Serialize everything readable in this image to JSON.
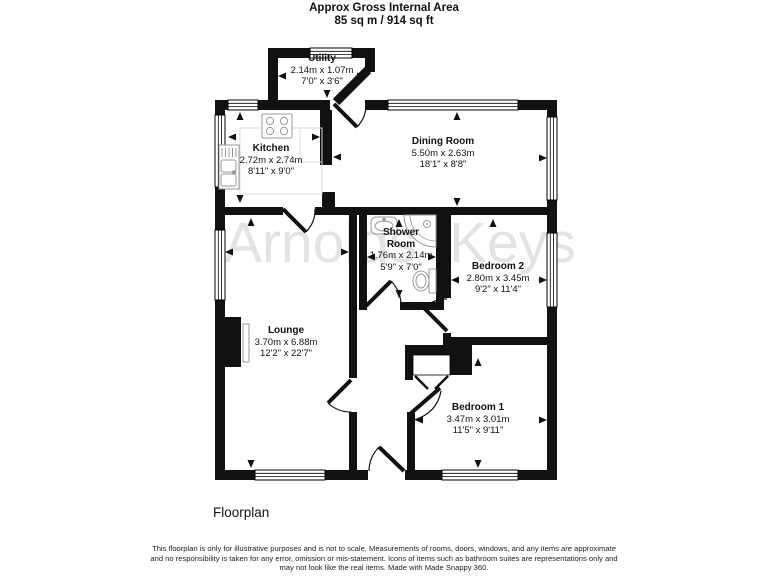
{
  "header": {
    "line1": "Approx Gross Internal Area",
    "line2": "85 sq m / 914 sq ft"
  },
  "watermark": "Arnolds Keys",
  "rooms": {
    "utility": {
      "name": "Utility",
      "metric": "2.14m x 1.07m",
      "imperial": "7'0\" x 3'6\""
    },
    "kitchen": {
      "name": "Kitchen",
      "metric": "2.72m x 2.74m",
      "imperial": "8'11\" x 9'0\""
    },
    "dining": {
      "name": "Dining Room",
      "metric": "5.50m x 2.63m",
      "imperial": "18'1\" x 8'8\""
    },
    "shower": {
      "name": "Shower Room",
      "metric": "1.76m x 2.14m",
      "imperial": "5'9\" x 7'0\""
    },
    "bedroom2": {
      "name": "Bedroom 2",
      "metric": "2.80m x 3.45m",
      "imperial": "9'2\" x 11'4\""
    },
    "lounge": {
      "name": "Lounge",
      "metric": "3.70m x 6.88m",
      "imperial": "12'2\" x 22'7\""
    },
    "bedroom1": {
      "name": "Bedroom 1",
      "metric": "3.47m x 3.01m",
      "imperial": "11'5\" x 9'11\""
    }
  },
  "footer": {
    "caption": "Floorplan",
    "disclaimer1": "This floorplan is only for illustrative purposes and is not to scale. Measurements of rooms, doors, windows, and any items are approximate",
    "disclaimer2": "and no responsibility is taken for any error, omission or mis-statement. Icons of items such as bathroom suites are representations only and",
    "disclaimer3": "may not look like the real items. Made with Made Snappy 360."
  },
  "colors": {
    "wall": "#111111",
    "fixture_outline": "#999999",
    "watermark": "#e3e3e3"
  }
}
